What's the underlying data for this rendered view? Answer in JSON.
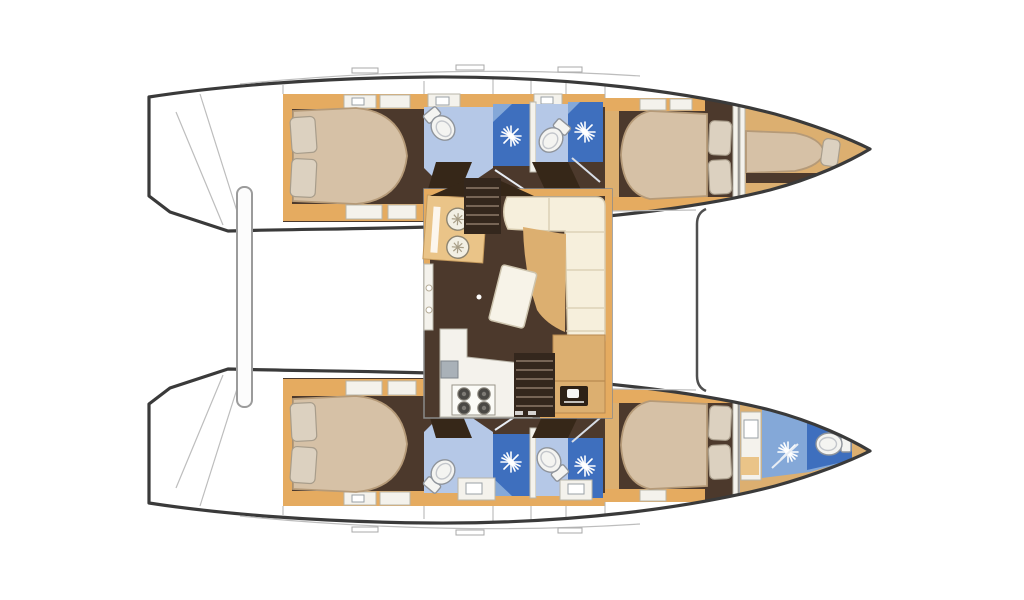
{
  "figure": {
    "label": "Catamaran interior layout floor plan",
    "type": "boat-floor-plan",
    "views": "top-down deck plan, two hulls with central saloon"
  },
  "colors": {
    "background": "#ffffff",
    "hull_outline": "#3a3a3a",
    "deck_line": "#bdbdbd",
    "divider": "#8a8a8a",
    "floor_dark": "#4c392c",
    "floor_shadow": "#362718",
    "wood_trim": "#e5ab60",
    "wood_mid": "#dcaf70",
    "wood_light": "#eac488",
    "bed": "#d6c1a6",
    "bed_edge": "#b59a78",
    "pillow": "#dcd1c0",
    "pillow_edge": "#a89d8b",
    "sofa": "#f6efdc",
    "sofa_seam": "#d8ccb0",
    "table_white": "#f7f3e8",
    "bath_light": "#b5c8e7",
    "bath_mid": "#84a8d8",
    "shower_dark": "#3e6fbe",
    "fixture_white": "#f4f4f1",
    "fixture_edge": "#8f949b",
    "counter_white": "#f4f2ec",
    "sink_gray": "#a9b1b8"
  },
  "icons": {
    "toilet-icon": "white oval bowl with cistern",
    "shower-icon": "white water-spray starburst on blue floor",
    "stove-icon": "four round burner cooktop",
    "round-sink-icon": "circular basin with drain star",
    "rect-sink-icon": "rectangular basin in vanity counter",
    "appliance-icon": "dark panel with white dial",
    "pillow-icon": "rounded rectangle cushion"
  }
}
